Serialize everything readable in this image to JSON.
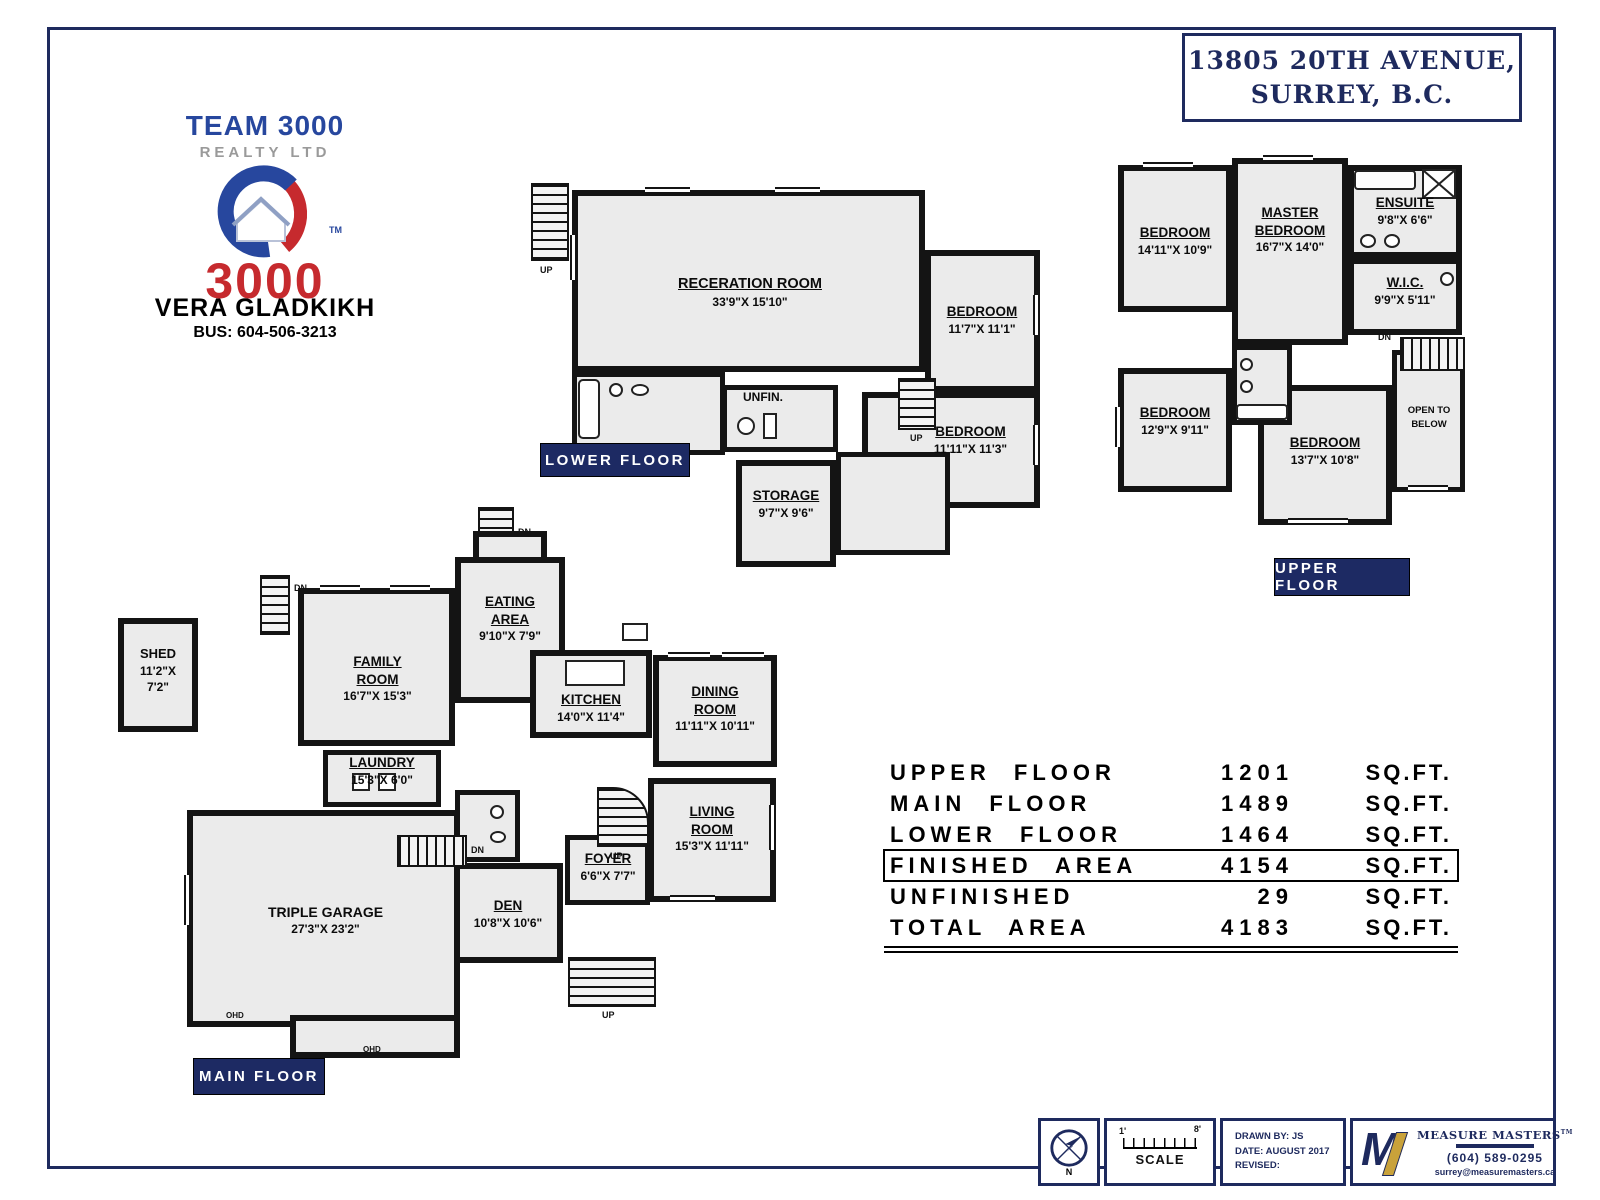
{
  "address": {
    "line1": "13805 20TH AVENUE,",
    "line2": "SURREY, B.C."
  },
  "brand": {
    "team": "TEAM 3000",
    "realty": "REALTY LTD",
    "big_number": "3000",
    "trademark": "TM",
    "agent_name": "VERA  GLADKIKH",
    "agent_phone": "BUS:  604-506-3213"
  },
  "floor_tags": {
    "lower": "LOWER  FLOOR",
    "upper": "UPPER  FLOOR",
    "main": "MAIN  FLOOR"
  },
  "misc": {
    "up": "UP",
    "dn": "DN",
    "ohd": "OHD"
  },
  "lower_floor": {
    "rec_room": {
      "name": "RECERATION ROOM",
      "dim": "33'9\"X  15'10\""
    },
    "bedroom1": {
      "name": "BEDROOM",
      "dim": "11'7\"X  11'1\""
    },
    "bedroom2": {
      "name": "BEDROOM",
      "dim": "11'11\"X  11'3\""
    },
    "unfin": {
      "name": "UNFIN."
    },
    "storage": {
      "name": "STORAGE",
      "dim": "9'7\"X  9'6\""
    }
  },
  "upper_floor": {
    "bedroom_tl": {
      "name": "BEDROOM",
      "dim": "14'11\"X  10'9\""
    },
    "master": {
      "name1": "MASTER",
      "name2": "BEDROOM",
      "dim": "16'7\"X  14'0\""
    },
    "ensuite": {
      "name": "ENSUITE",
      "dim": "9'8\"X  6'6\""
    },
    "wic": {
      "name": "W.I.C.",
      "dim": "9'9\"X  5'11\""
    },
    "bedroom_ml": {
      "name": "BEDROOM",
      "dim": "12'9\"X  9'11\""
    },
    "bedroom_bc": {
      "name": "BEDROOM",
      "dim": "13'7\"X  10'8\""
    },
    "open_below": {
      "line1": "OPEN TO",
      "line2": "BELOW"
    }
  },
  "main_floor": {
    "shed": {
      "name": "SHED",
      "dim1": "11'2\"X",
      "dim2": "7'2\""
    },
    "family": {
      "name1": "FAMILY",
      "name2": "ROOM",
      "dim": "16'7\"X  15'3\""
    },
    "eating": {
      "name1": "EATING",
      "name2": "AREA",
      "dim": "9'10\"X  7'9\""
    },
    "kitchen": {
      "name": "KITCHEN",
      "dim": "14'0\"X  11'4\""
    },
    "dining": {
      "name1": "DINING",
      "name2": "ROOM",
      "dim": "11'11\"X  10'11\""
    },
    "laundry": {
      "name": "LAUNDRY",
      "dim": "15'3\"X  6'0\""
    },
    "garage": {
      "name": "TRIPLE GARAGE",
      "dim": "27'3\"X  23'2\""
    },
    "den": {
      "name": "DEN",
      "dim": "10'8\"X  10'6\""
    },
    "foyer": {
      "name": "FOYER",
      "dim": "6'6\"X  7'7\""
    },
    "living": {
      "name1": "LIVING",
      "name2": "ROOM",
      "dim": "15'3\"X  11'11\""
    }
  },
  "area_table": {
    "rows": [
      {
        "label": "UPPER FLOOR",
        "value": "1201",
        "unit": "SQ.FT."
      },
      {
        "label": "MAIN FLOOR",
        "value": "1489",
        "unit": "SQ.FT."
      },
      {
        "label": "LOWER FLOOR",
        "value": "1464",
        "unit": "SQ.FT."
      },
      {
        "label": "FINISHED AREA",
        "value": "4154",
        "unit": "SQ.FT."
      },
      {
        "label": "UNFINISHED",
        "value": "29",
        "unit": "SQ.FT."
      },
      {
        "label": "TOTAL AREA",
        "value": "4183",
        "unit": "SQ.FT."
      }
    ]
  },
  "footer": {
    "compass_n": "N",
    "scale_left": "1'",
    "scale_right": "8'",
    "scale_label": "SCALE",
    "drawn_by": "DRAWN BY: JS",
    "date": "DATE: AUGUST 2017",
    "revised": "REVISED:",
    "mm_name": "MEASURE MASTERS",
    "mm_tm": "TM",
    "mm_phone": "(604) 589-0295",
    "mm_email": "surrey@measuremasters.ca"
  }
}
